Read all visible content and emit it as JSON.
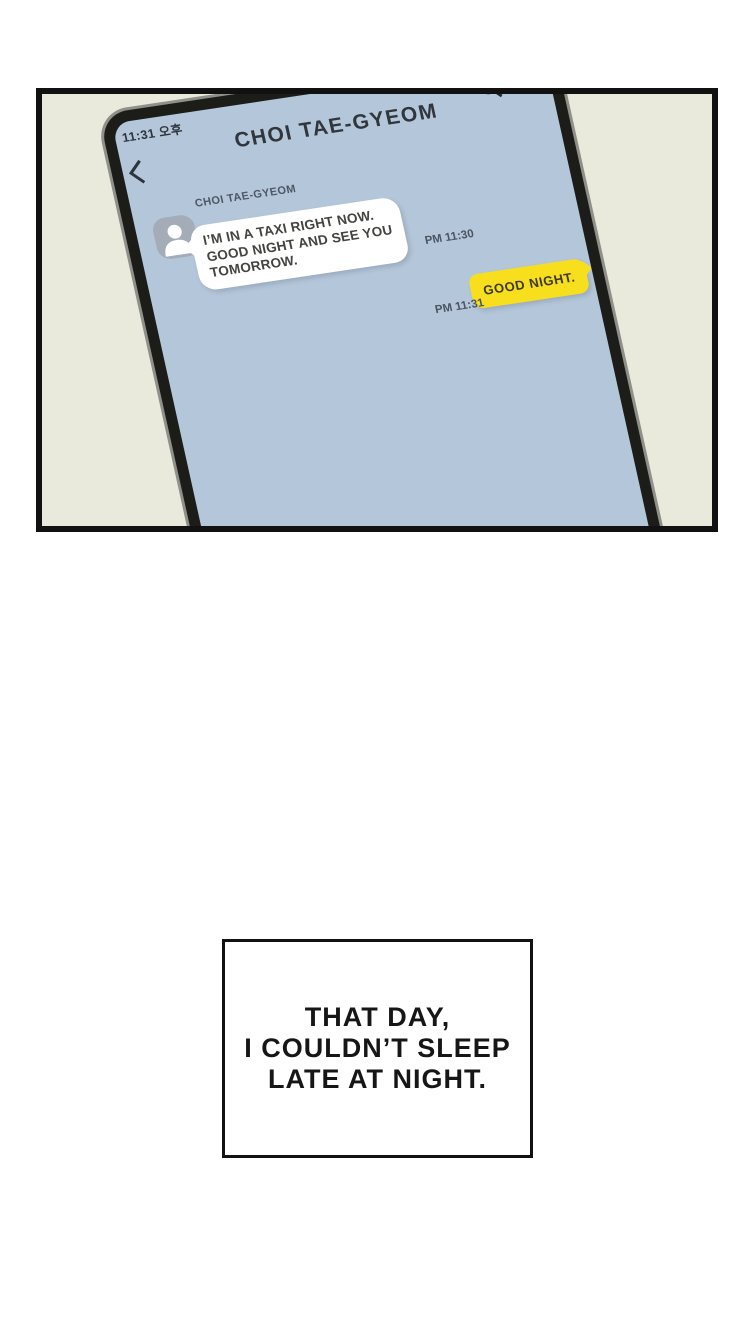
{
  "colors": {
    "page_bg": "#ffffff",
    "panel_bg": "#e9e9dc",
    "panel_border": "#111111",
    "phone_frame": "#90908a",
    "phone_bezel": "#1c1c19",
    "screen_bg": "#b4c6d9",
    "incoming_bubble_bg": "#ffffff",
    "outgoing_bubble_bg": "#f7df1d",
    "timestamp_color": "#4b5563"
  },
  "phone": {
    "status_time": "11:31 오후",
    "chat_title": "CHOI TAE-GYEOM",
    "sender_name": "CHOI TAE-GYEOM",
    "incoming_lines": [
      "I’M IN A TAXI RIGHT NOW.",
      "GOOD NIGHT AND SEE YOU",
      "TOMORROW."
    ],
    "incoming_time": "PM 11:30",
    "outgoing_message": "GOOD NIGHT.",
    "outgoing_time": "PM 11:31",
    "icons": {
      "back": "back-chevron",
      "search": "magnifying-glass",
      "avatar": "person-silhouette"
    }
  },
  "caption": {
    "lines": [
      "THAT DAY,",
      "I COULDN’T SLEEP",
      "LATE AT NIGHT."
    ]
  }
}
